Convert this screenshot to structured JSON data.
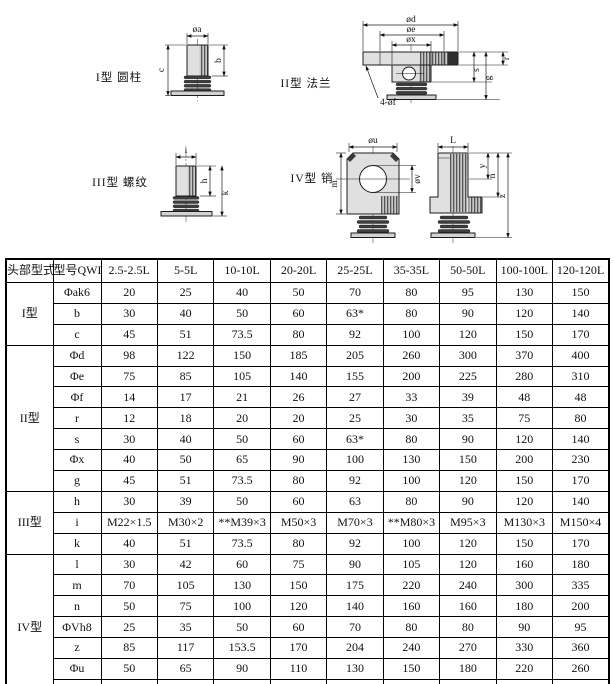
{
  "diagrams": {
    "type1": {
      "label": "I型 圆柱",
      "dim_a": "øa",
      "dim_b": "b",
      "dim_c": "c"
    },
    "type2": {
      "label": "II型 法兰",
      "dim_d": "ød",
      "dim_e": "øe",
      "dim_x": "øx",
      "dim_r": "r",
      "dim_s": "s",
      "dim_g": "g",
      "dim_f": "4-øf"
    },
    "type3": {
      "label": "III型 螺纹",
      "dim_i": "i",
      "dim_h": "h",
      "dim_k": "k"
    },
    "type4": {
      "label": "IV型 销",
      "dim_u": "øu",
      "dim_L": "L",
      "dim_m": "m",
      "dim_v": "øv",
      "dim_y": "y",
      "dim_n": "n",
      "dim_z": "z"
    }
  },
  "table": {
    "col_headers": [
      "头部型式",
      "型号QWL",
      "2.5-2.5L",
      "5-5L",
      "10-10L",
      "20-20L",
      "25-25L",
      "35-35L",
      "50-50L",
      "100-100L",
      "120-120L"
    ],
    "groups": [
      {
        "label": "I型",
        "rows": [
          {
            "param": "Φak6",
            "values": [
              "20",
              "25",
              "40",
              "50",
              "70",
              "80",
              "95",
              "130",
              "150"
            ]
          },
          {
            "param": "b",
            "values": [
              "30",
              "40",
              "50",
              "60",
              "63*",
              "80",
              "90",
              "120",
              "140"
            ]
          },
          {
            "param": "c",
            "values": [
              "45",
              "51",
              "73.5",
              "80",
              "92",
              "100",
              "120",
              "150",
              "170"
            ]
          }
        ]
      },
      {
        "label": "II型",
        "rows": [
          {
            "param": "Φd",
            "values": [
              "98",
              "122",
              "150",
              "185",
              "205",
              "260",
              "300",
              "370",
              "400"
            ]
          },
          {
            "param": "Φe",
            "values": [
              "75",
              "85",
              "105",
              "140",
              "155",
              "200",
              "225",
              "280",
              "310"
            ]
          },
          {
            "param": "Φf",
            "values": [
              "14",
              "17",
              "21",
              "26",
              "27",
              "33",
              "39",
              "48",
              "48"
            ]
          },
          {
            "param": "r",
            "values": [
              "12",
              "18",
              "20",
              "20",
              "25",
              "30",
              "35",
              "75",
              "80"
            ]
          },
          {
            "param": "s",
            "values": [
              "30",
              "40",
              "50",
              "60",
              "63*",
              "80",
              "90",
              "120",
              "140"
            ]
          },
          {
            "param": "Φx",
            "values": [
              "40",
              "50",
              "65",
              "90",
              "100",
              "130",
              "150",
              "200",
              "230"
            ]
          },
          {
            "param": "g",
            "values": [
              "45",
              "51",
              "73.5",
              "80",
              "92",
              "100",
              "120",
              "150",
              "170"
            ]
          }
        ]
      },
      {
        "label": "III型",
        "rows": [
          {
            "param": "h",
            "values": [
              "30",
              "39",
              "50",
              "60",
              "63",
              "80",
              "90",
              "120",
              "140"
            ]
          },
          {
            "param": "i",
            "values": [
              "M22×1.5",
              "M30×2",
              "**M39×3",
              "M50×3",
              "M70×3",
              "**M80×3",
              "M95×3",
              "M130×3",
              "M150×4"
            ]
          },
          {
            "param": "k",
            "values": [
              "40",
              "51",
              "73.5",
              "80",
              "92",
              "100",
              "120",
              "150",
              "170"
            ]
          }
        ]
      },
      {
        "label": "IV型",
        "rows": [
          {
            "param": "l",
            "values": [
              "30",
              "42",
              "60",
              "75",
              "90",
              "105",
              "120",
              "160",
              "180"
            ]
          },
          {
            "param": "m",
            "values": [
              "70",
              "105",
              "130",
              "150",
              "175",
              "220",
              "240",
              "300",
              "335"
            ]
          },
          {
            "param": "n",
            "values": [
              "50",
              "75",
              "100",
              "120",
              "140",
              "160",
              "160",
              "180",
              "200"
            ]
          },
          {
            "param": "ΦVh8",
            "values": [
              "25",
              "35",
              "50",
              "60",
              "70",
              "80",
              "80",
              "90",
              "95"
            ]
          },
          {
            "param": "z",
            "values": [
              "85",
              "117",
              "153.5",
              "170",
              "204",
              "240",
              "270",
              "330",
              "360"
            ]
          },
          {
            "param": "Φu",
            "values": [
              "50",
              "65",
              "90",
              "110",
              "130",
              "150",
              "180",
              "220",
              "260"
            ]
          },
          {
            "param": "y",
            "values": [
              "25",
              "37.5",
              "50",
              "60",
              "70",
              "80",
              "80",
              "90",
              "100"
            ]
          }
        ]
      }
    ]
  }
}
